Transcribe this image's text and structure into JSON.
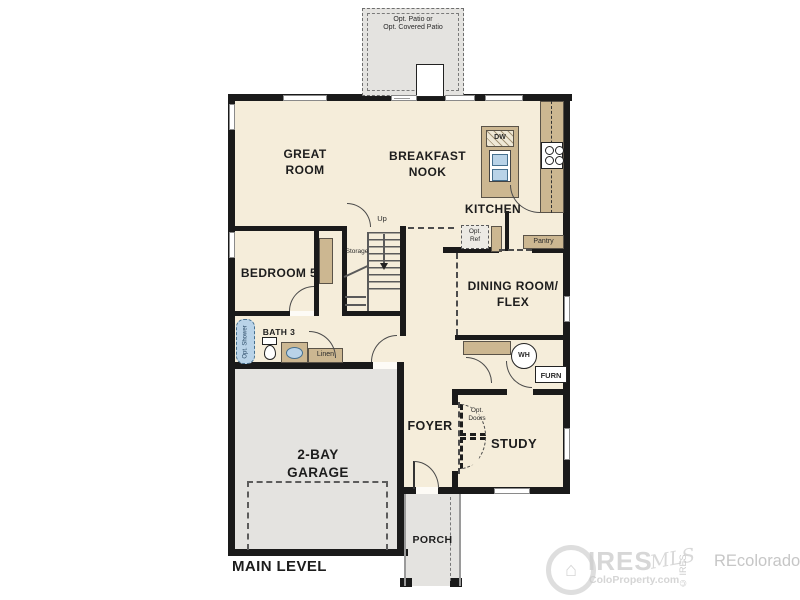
{
  "plan": {
    "level_label": "MAIN LEVEL",
    "rooms": {
      "great_room": {
        "line1": "GREAT",
        "line2": "ROOM"
      },
      "breakfast_nook": {
        "line1": "BREAKFAST",
        "line2": "NOOK"
      },
      "kitchen": {
        "label": "KITCHEN"
      },
      "bedroom5": {
        "label": "BEDROOM 5"
      },
      "dining": {
        "line1": "DINING ROOM/",
        "line2": "FLEX"
      },
      "bath3": {
        "label": "BATH 3"
      },
      "garage": {
        "line1": "2-BAY",
        "line2": "GARAGE"
      },
      "foyer": {
        "label": "FOYER"
      },
      "study": {
        "label": "STUDY"
      },
      "porch": {
        "label": "PORCH"
      }
    },
    "features": {
      "patio": {
        "line1": "Opt. Patio or",
        "line2": "Opt. Covered Patio"
      },
      "storage": "Storage",
      "up": "Up",
      "dw": "DW",
      "opt_ref": {
        "line1": "Opt.",
        "line2": "Ref"
      },
      "pantry": "Pantry",
      "linen": "Linen",
      "opt_shower": "Opt. Shower",
      "wh": "WH",
      "furn": "FURN",
      "opt_doors": {
        "line1": "Opt.",
        "line2": "Doors"
      }
    },
    "watermark": {
      "brand": "IRES",
      "brand_script": "MLS",
      "site": "ColoProperty.com",
      "copyright": "© IRES",
      "secondary": "REcolorado"
    },
    "colors": {
      "floor": "#f5edda",
      "hardscape": "#e4e3e0",
      "counter": "#ccb791",
      "fixture": "#b9d3e8",
      "wall": "#1a1a1a"
    }
  }
}
